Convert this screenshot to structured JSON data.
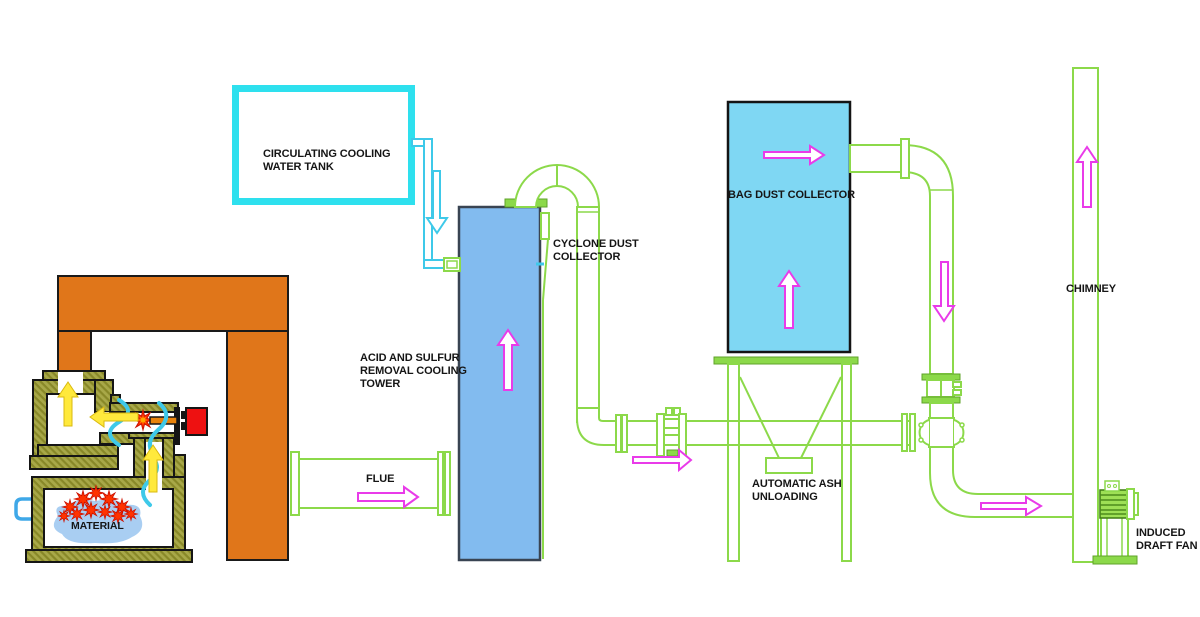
{
  "diagram_type": "incinerator-flue-gas-treatment-process-flow",
  "labels": {
    "tank": {
      "lines": [
        "CIRCULATING COOLING",
        "WATER TANK"
      ]
    },
    "tower": {
      "lines": [
        "ACID AND SULFUR",
        "REMOVAL COOLING",
        "TOWER"
      ]
    },
    "cyclone": {
      "lines": [
        "CYCLONE DUST",
        "COLLECTOR"
      ]
    },
    "bag_collector": {
      "text": "BAG DUST COLLECTOR"
    },
    "ash": {
      "lines": [
        "AUTOMATIC ASH",
        "UNLOADING"
      ]
    },
    "flue": {
      "text": "FLUE"
    },
    "chimney": {
      "text": "CHIMNEY"
    },
    "fan": {
      "lines": [
        "INDUCED",
        "DRAFT FAN"
      ]
    },
    "material": {
      "text": "MATERIAL"
    }
  },
  "colors": {
    "pipe_green": "#8cd94a",
    "flow_arrow_magenta": "#e93be9",
    "water_cyan": "#2ee0ee",
    "frame_orange": "#e0761a",
    "furnace_wall_olive": "#a3a344",
    "tower_blue": "#82bbef",
    "bag_collector_blue": "#7fd7f3",
    "material_blue": "#a9cef2",
    "flame_red": "#ff3300",
    "hot_gas_yellow": "#ffe93c",
    "label_black": "#151515"
  },
  "flow_arrows": [
    {
      "name": "furnace-updraft",
      "direction": "up",
      "color": "yellow"
    },
    {
      "name": "furnace-crossflow",
      "direction": "left",
      "color": "yellow"
    },
    {
      "name": "furnace-riser",
      "direction": "up",
      "color": "yellow"
    },
    {
      "name": "cooling-water-feed",
      "direction": "down",
      "color": "cyan"
    },
    {
      "name": "flue-gas-to-tower",
      "direction": "right",
      "color": "magenta"
    },
    {
      "name": "tower-upflow",
      "direction": "up",
      "color": "magenta"
    },
    {
      "name": "duct-to-baghouse",
      "direction": "right",
      "color": "magenta"
    },
    {
      "name": "baghouse-upflow",
      "direction": "up",
      "color": "magenta"
    },
    {
      "name": "baghouse-outlet",
      "direction": "right",
      "color": "magenta"
    },
    {
      "name": "downcomer",
      "direction": "down",
      "color": "magenta"
    },
    {
      "name": "fan-inlet",
      "direction": "right",
      "color": "magenta"
    },
    {
      "name": "chimney-exhaust",
      "direction": "up",
      "color": "magenta"
    }
  ]
}
